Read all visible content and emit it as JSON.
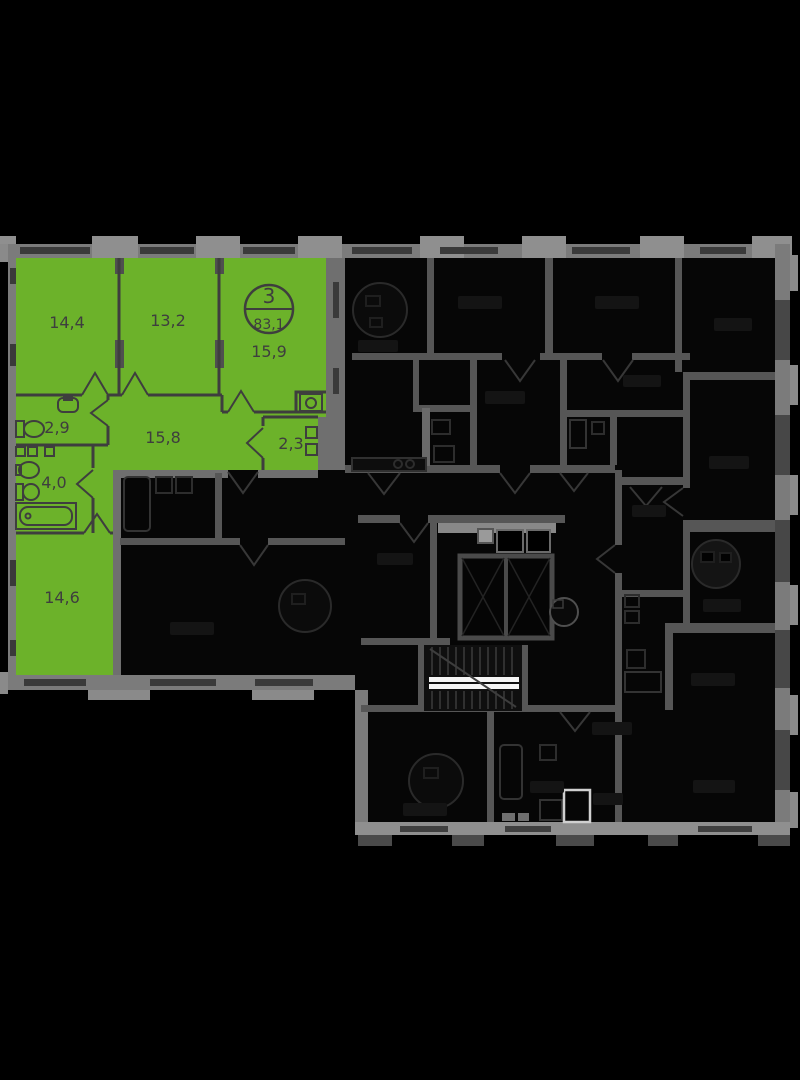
{
  "plan": {
    "badge": {
      "room_count": "3",
      "total_area": "83,1"
    },
    "apartment": {
      "rooms": [
        {
          "id": "room-top-left",
          "area": "14,4"
        },
        {
          "id": "room-top-middle",
          "area": "13,2"
        },
        {
          "id": "room-top-right",
          "area": "15,9"
        },
        {
          "id": "wc",
          "area": "2,9"
        },
        {
          "id": "hallway",
          "area": "15,8"
        },
        {
          "id": "storage",
          "area": "2,3"
        },
        {
          "id": "bathroom",
          "area": "4,0"
        },
        {
          "id": "room-bottom-left",
          "area": "14,6"
        }
      ]
    },
    "colors": {
      "highlight": "#6cb22a",
      "outer_wall": "#7b7b7b",
      "inner_wall": "#565656",
      "dim_fill": "#060606",
      "label": "#3e3e3e",
      "background": "#000000"
    }
  }
}
